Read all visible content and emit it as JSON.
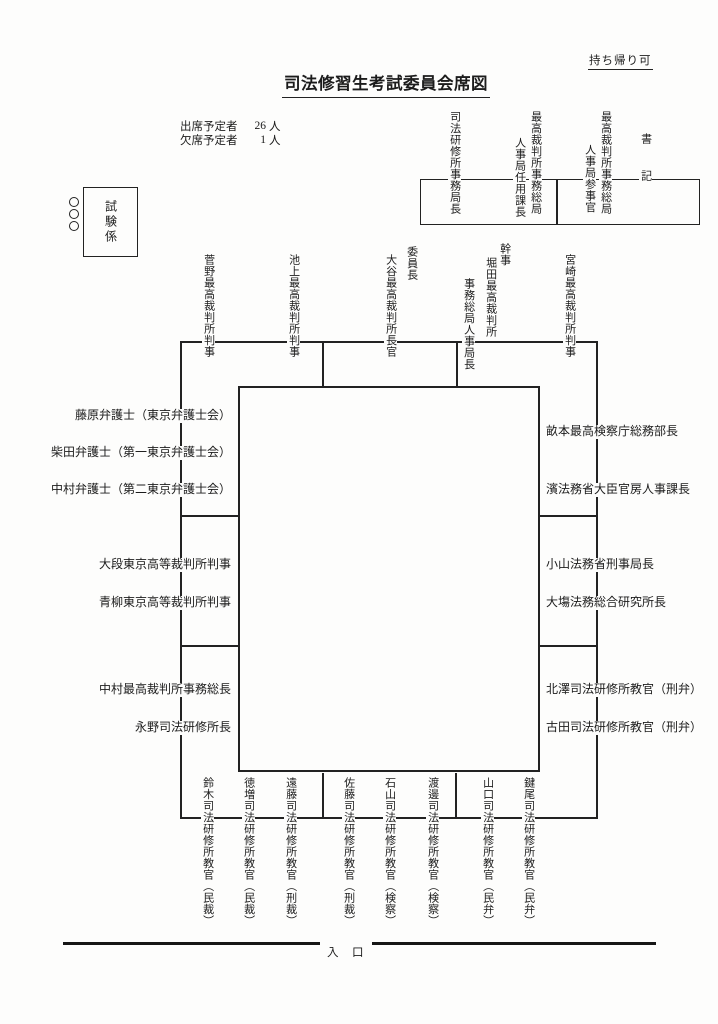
{
  "document": {
    "note_top_right": "持ち帰り可",
    "title": "司法修習生考試委員会席図",
    "attendance": {
      "rows": [
        {
          "label": "出席予定者",
          "count": "26",
          "unit": "人"
        },
        {
          "label": "欠席予定者",
          "count": "1",
          "unit": "人"
        }
      ]
    },
    "entrance": "入　口"
  },
  "exam_staff": {
    "label": "試験係"
  },
  "clerk_area": {
    "seat1": {
      "col1": "司法研修所事務局長"
    },
    "seat2": {
      "col1": "最高裁判所事務総局",
      "col2": "人事局任用課長"
    },
    "seat3": {
      "col1": "最高裁判所事務総局",
      "col2": "人事局参事官"
    },
    "clerk_label": "書記"
  },
  "top_row": {
    "chairman_role": "委員長",
    "secretary_role": "幹事",
    "seats": [
      {
        "name": "菅野最高裁判所判事"
      },
      {
        "name": "池上最高裁判所判事"
      },
      {
        "name": "大谷最高裁判所長官"
      },
      {
        "col1": "堀田最高裁判所",
        "col2": "事務総局人事局長"
      },
      {
        "name": "宮崎最高裁判所判事"
      }
    ]
  },
  "left_column": [
    "藤原弁護士（東京弁護士会）",
    "柴田弁護士（第一東京弁護士会）",
    "中村弁護士（第二東京弁護士会）",
    "大段東京高等裁判所判事",
    "青柳東京高等裁判所判事",
    "中村最高裁判所事務総長",
    "永野司法研修所長"
  ],
  "right_column": [
    "畝本最高検察庁総務部長",
    "濱法務省大臣官房人事課長",
    "小山法務省刑事局長",
    "大塲法務総合研究所長",
    "北澤司法研修所教官（刑弁）",
    "古田司法研修所教官（刑弁）"
  ],
  "bottom_row": [
    "鈴木司法研修所教官（民裁）",
    "徳増司法研修所教官（民裁）",
    "遠藤司法研修所教官（刑裁）",
    "佐藤司法研修所教官（刑裁）",
    "石山司法研修所教官（検察）",
    "渡邊司法研修所教官（検察）",
    "山口司法研修所教官（民弁）",
    "鍵尾司法研修所教官（民弁）"
  ]
}
